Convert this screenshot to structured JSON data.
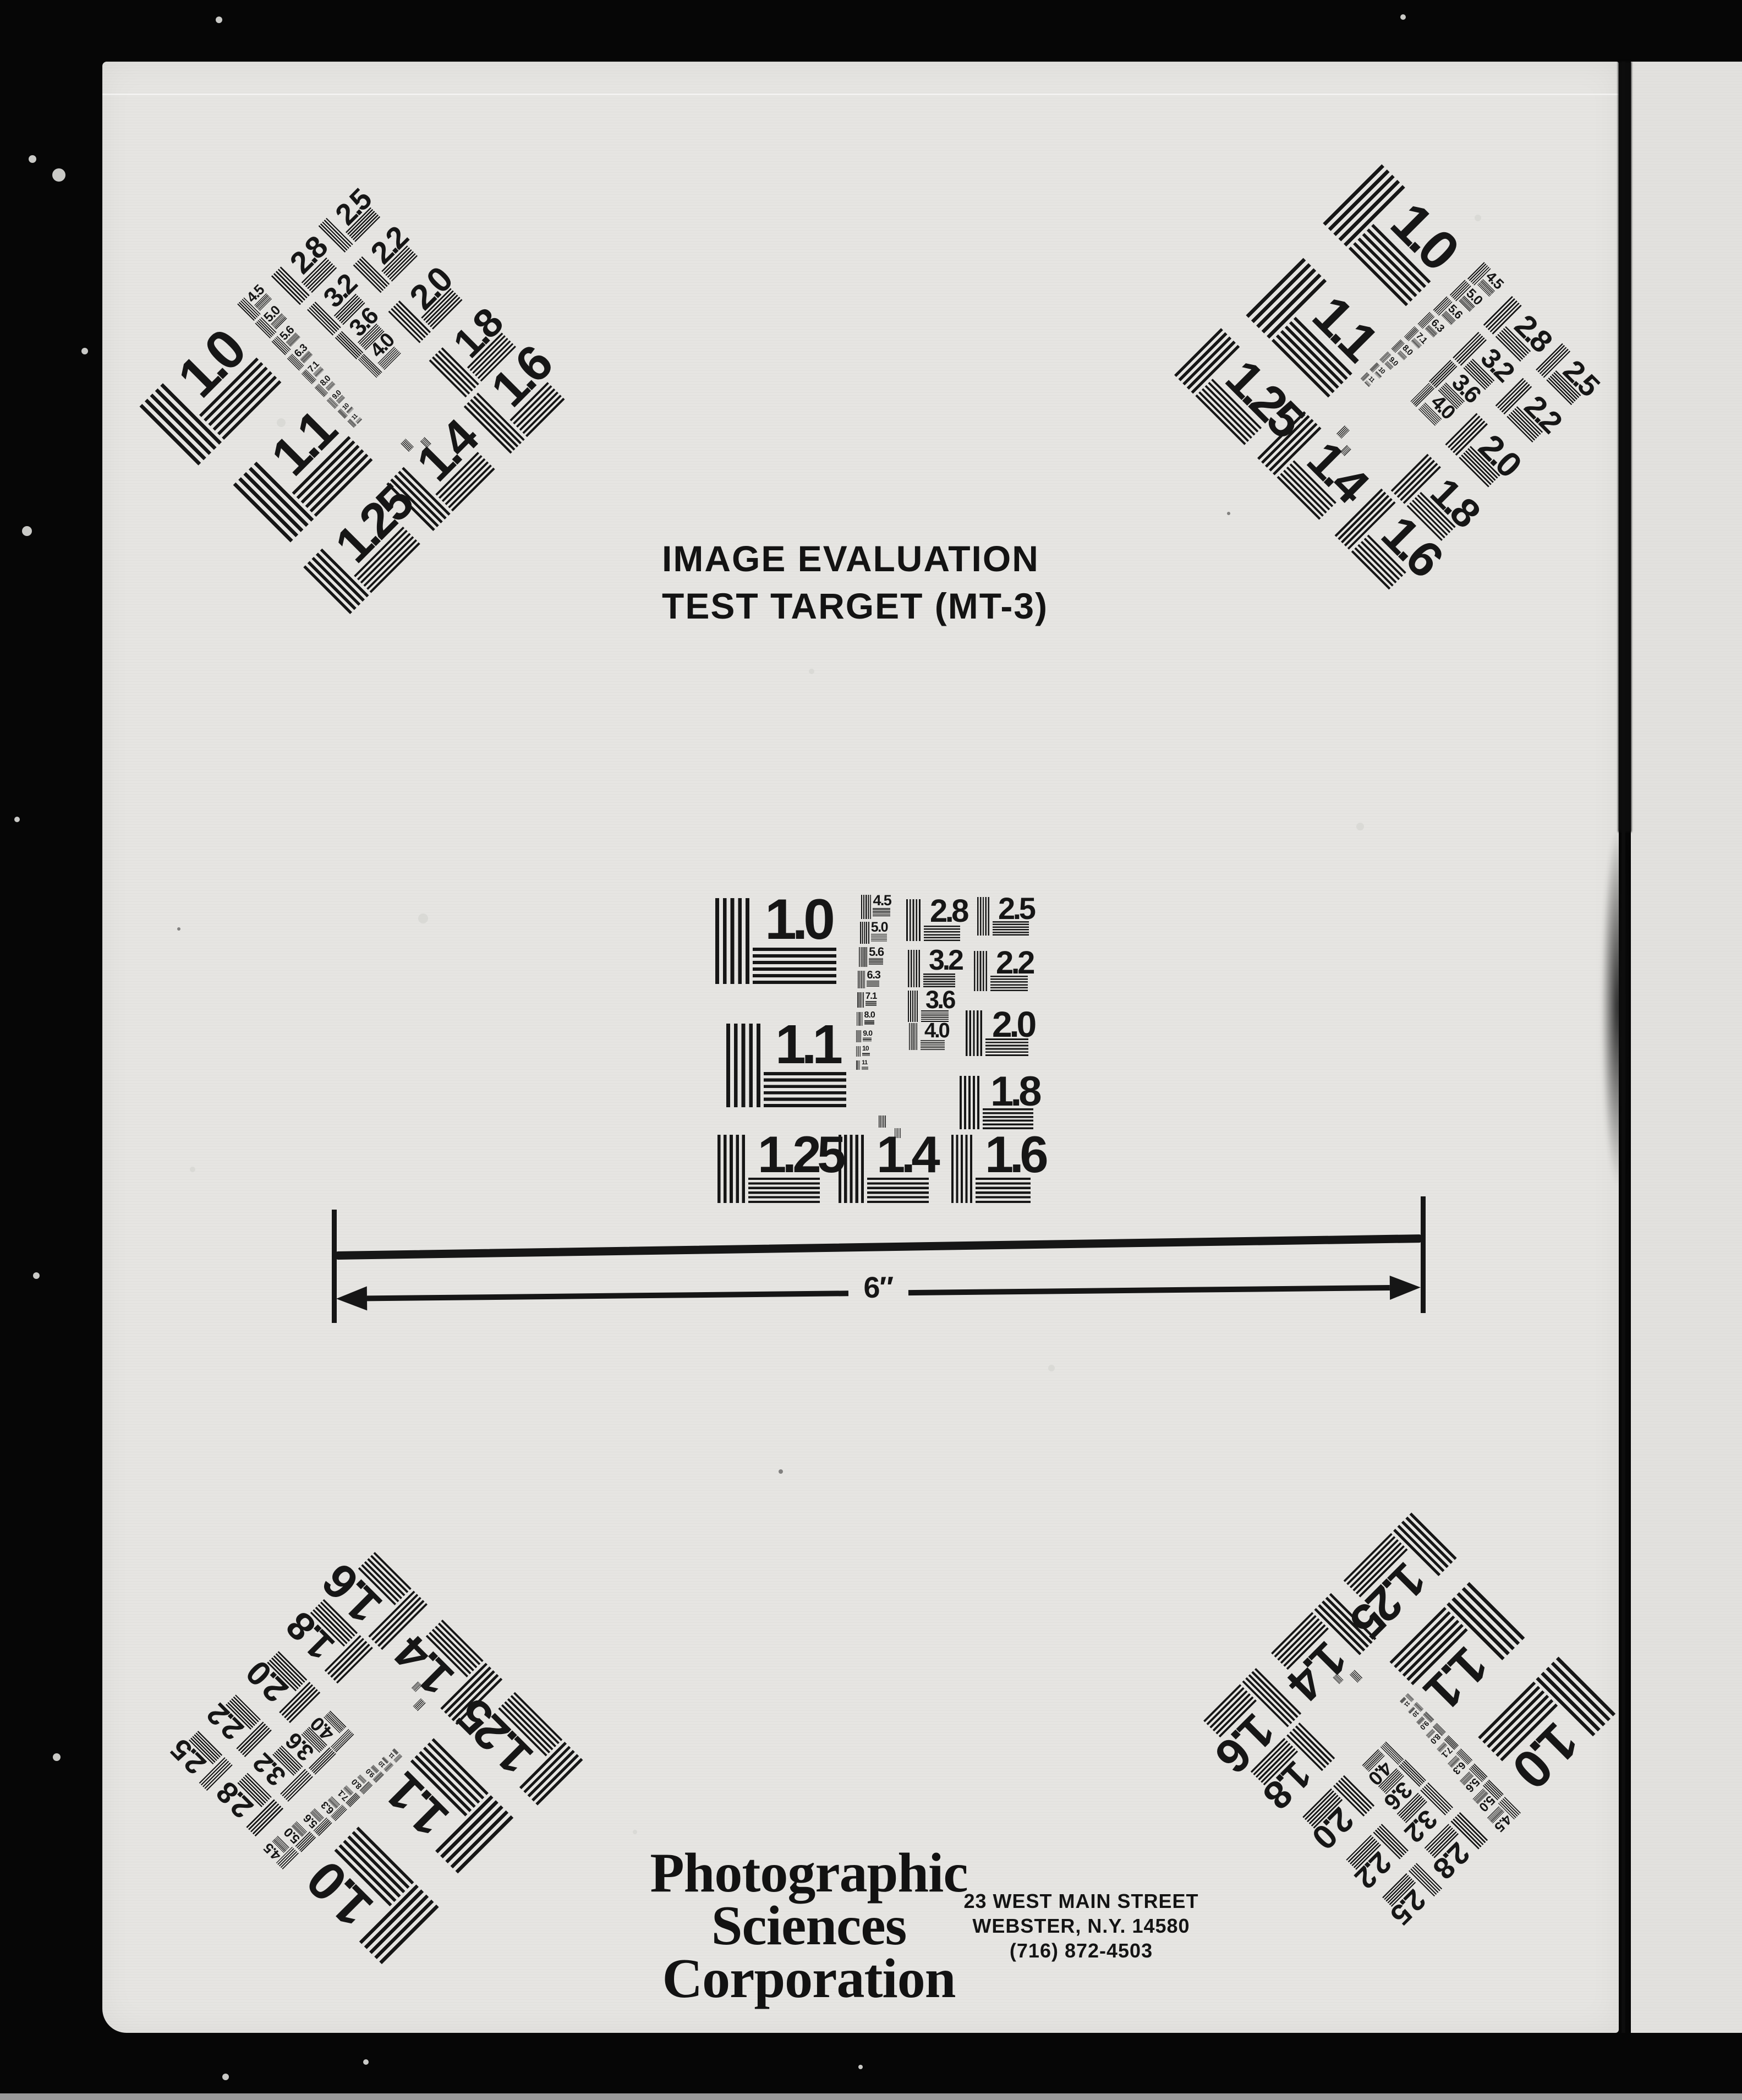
{
  "document": {
    "title_line1": "IMAGE EVALUATION",
    "title_line2": "TEST TARGET (MT-3)",
    "scale_label": "6″",
    "company_name_lines": [
      "Photographic",
      "Sciences",
      "Corporation"
    ],
    "address_lines": [
      "23 WEST MAIN STREET",
      "WEBSTER, N.Y. 14580",
      "(716) 872-4503"
    ]
  },
  "target": {
    "groups": [
      {
        "label": "1.0"
      },
      {
        "label": "1.1"
      },
      {
        "label": "1.25"
      },
      {
        "label": "1.4"
      },
      {
        "label": "1.6"
      },
      {
        "label": "2.8"
      },
      {
        "label": "3.2"
      },
      {
        "label": "3.6"
      },
      {
        "label": "4.0"
      },
      {
        "label": "2.5"
      },
      {
        "label": "2.2"
      },
      {
        "label": "2.0"
      },
      {
        "label": "1.8"
      }
    ],
    "ladder": [
      "4.5",
      "5.0",
      "5.6",
      "6.3",
      "7.1",
      "8.0",
      "9.0",
      "10",
      "11"
    ]
  },
  "colors": {
    "ink": "#161616",
    "paper": "#e6e5e2",
    "paper_right": "#e2e1de",
    "backdrop": "#060606",
    "bottom_strip": "#9a9a9a"
  }
}
